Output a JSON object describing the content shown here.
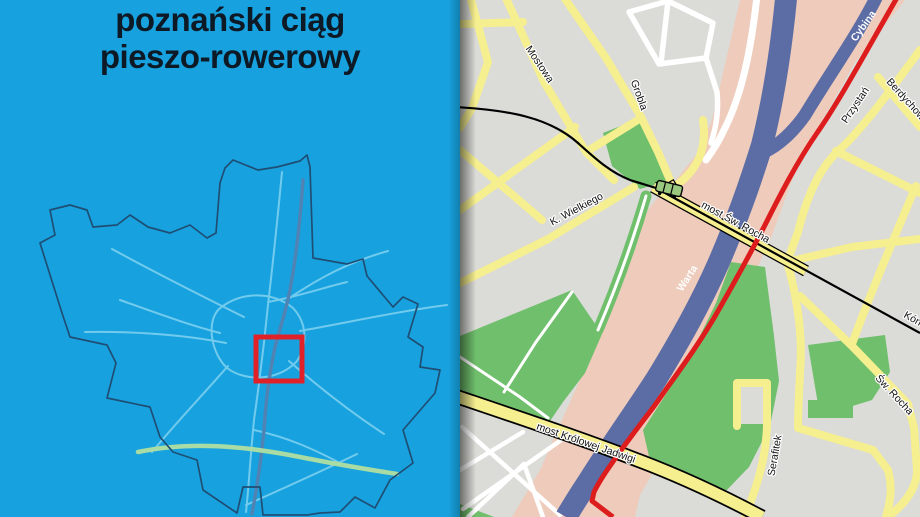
{
  "left_panel": {
    "title_line1": "poznański ciąg",
    "title_line2": "pieszo-rowerowy",
    "colors": {
      "background": "#17A2DF",
      "title_text": "#0D1A26",
      "city_boundary": "#1F4E74",
      "roads": "#72CBED",
      "river": "#4F83B4",
      "motorway_green": "#A9DBA4",
      "highlight_rect": "#E02228"
    }
  },
  "detail_map": {
    "labels": {
      "mostowa": "Mostowa",
      "grobla": "Grobla",
      "cybina": "Cybina",
      "przystan": "Przystań",
      "berdychowo": "Berdychowo",
      "k_wielkiego": "K. Wielkiego",
      "most_sw_rocha": "most Św. Rocha",
      "warta": "Warta",
      "kornicka": "Kórnicka",
      "sw_rocha": "Św. Rocha",
      "serafitek": "Serafitek",
      "most_krolowej_jadwigi": "most Królowej Jadwigi"
    },
    "colors": {
      "background": "#DBDBD7",
      "road_yellow": "#F6EF90",
      "road_white": "#FFFFFF",
      "park_green": "#6FBF6C",
      "floodplain_pink": "#EECBBA",
      "river_blue": "#5C6CA5",
      "route_red": "#DD1D1D",
      "tram_line": "#000000"
    }
  }
}
